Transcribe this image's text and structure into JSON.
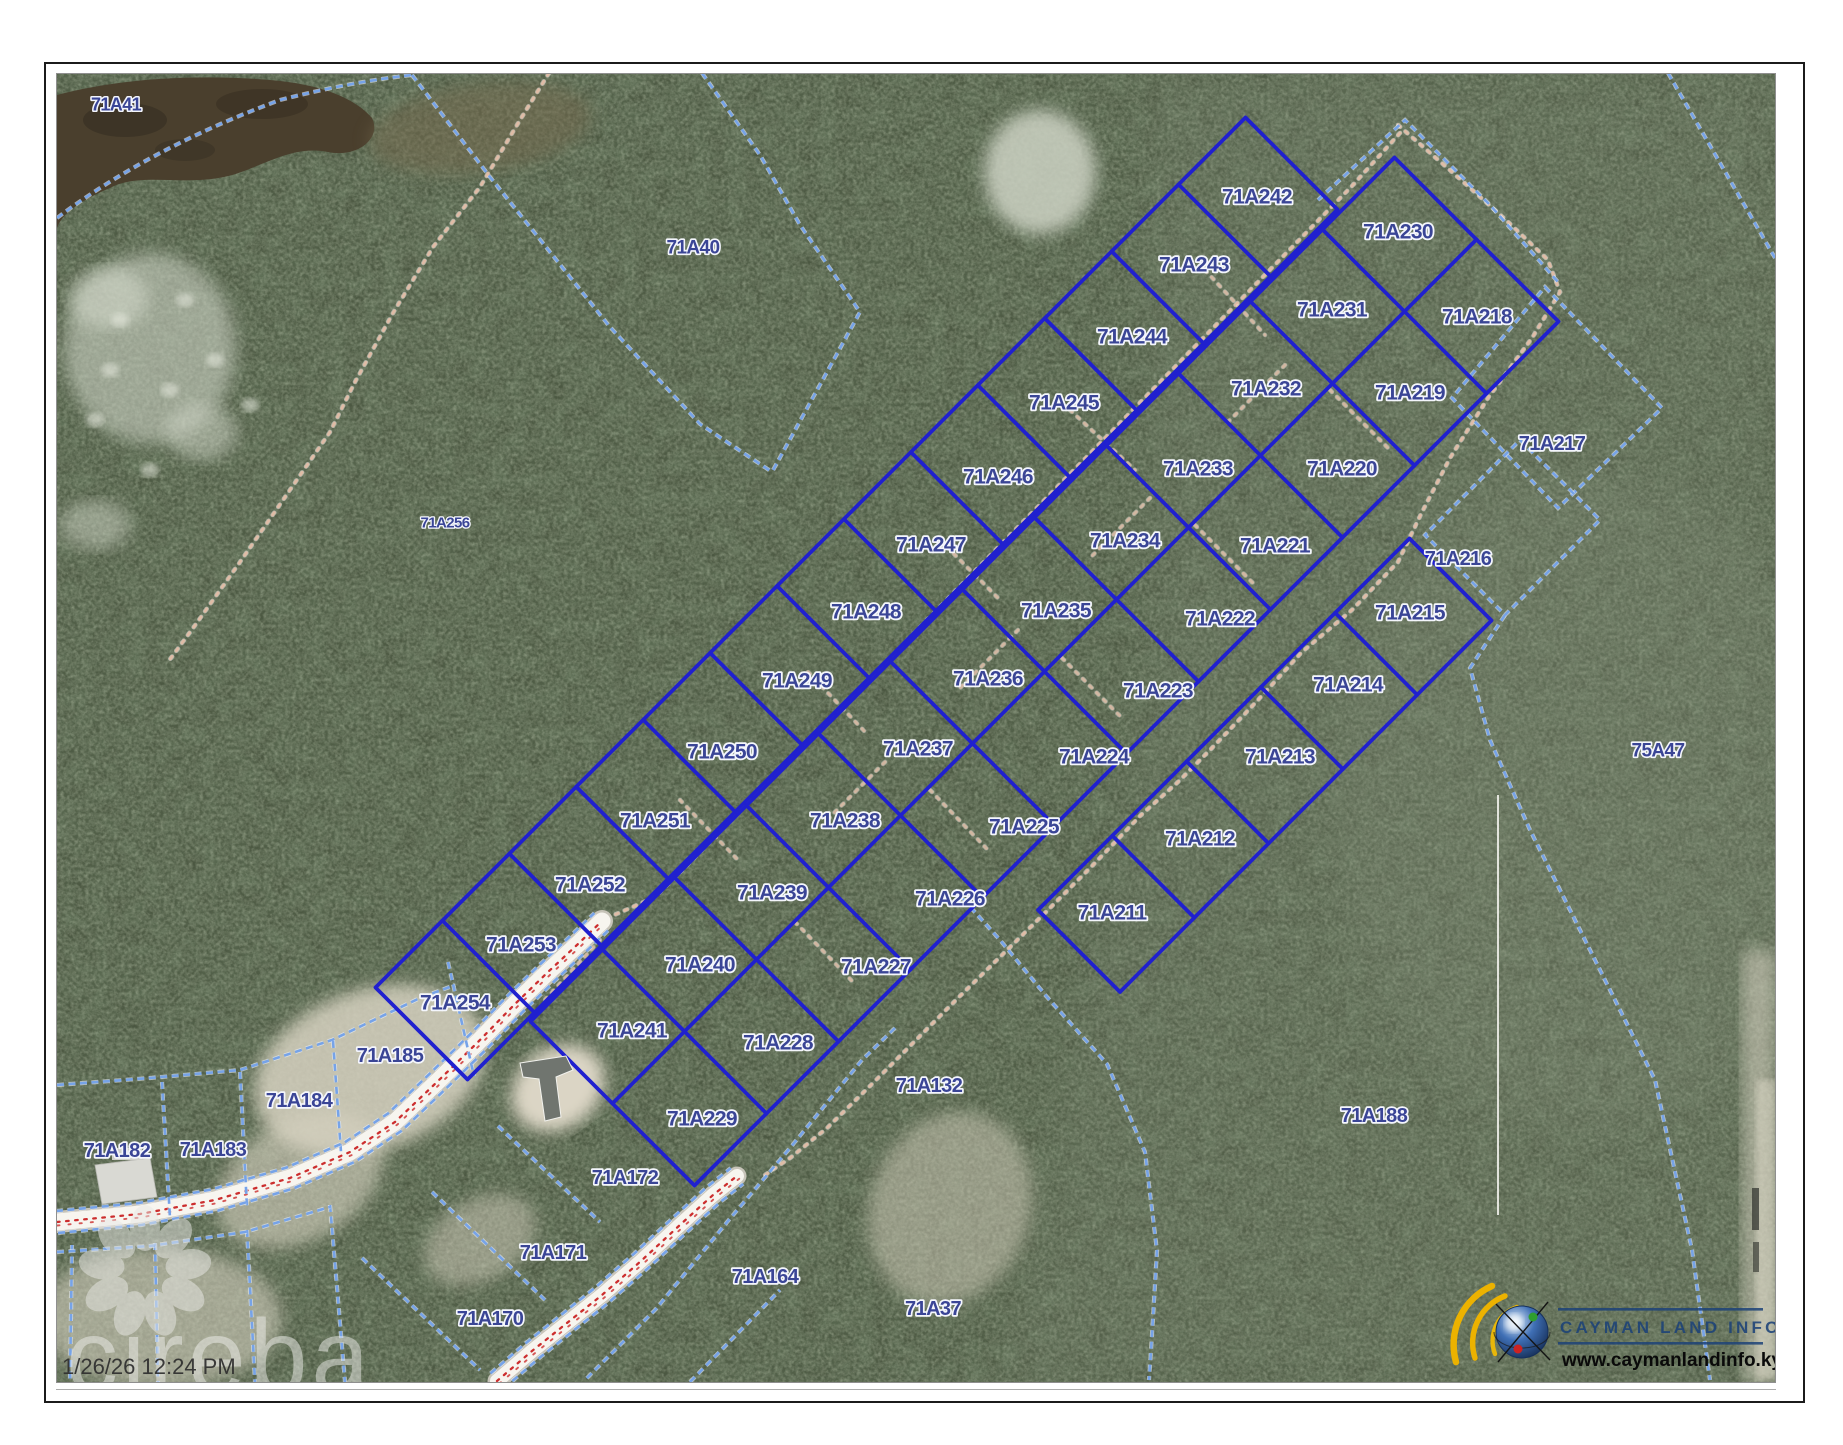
{
  "page": {
    "type": "cadastral-map-export",
    "timestamp": "1/26/26 12:24 PM",
    "watermark": "cireba"
  },
  "logo": {
    "name": "Cayman Land Info",
    "line1": "CAYMAN LAND INFO",
    "line2": "www.caymanlandinfo.ky"
  },
  "colors": {
    "parcel_line_solid": "#2020cf",
    "parcel_line_dashed": "#76a3e8",
    "dashed_casing": "#eef3fb",
    "road_fill": "#f7f5ef",
    "road_casing": "#c7c4b9",
    "road_centerline": "#cc2e2e",
    "trail_dot": "#e2bda6",
    "label_fill": "#3a4596",
    "label_halo": "#f4f6fc",
    "water": "#4a3f2d",
    "sand": "#d9d4c3",
    "logo_navy": "#1c4278",
    "logo_yellow": "#ecb200"
  },
  "map": {
    "parcels": [
      [
        "71A41",
        116,
        104,
        18
      ],
      [
        "71A40",
        693,
        247,
        19
      ],
      [
        "71A256",
        445,
        522,
        15
      ],
      [
        "75A47",
        1658,
        750,
        19
      ],
      [
        "71A242",
        1257,
        196
      ],
      [
        "71A243",
        1194,
        264
      ],
      [
        "71A244",
        1132,
        336
      ],
      [
        "71A245",
        1064,
        402
      ],
      [
        "71A246",
        998,
        476
      ],
      [
        "71A247",
        931,
        544
      ],
      [
        "71A248",
        866,
        611
      ],
      [
        "71A249",
        797,
        680
      ],
      [
        "71A250",
        722,
        751
      ],
      [
        "71A251",
        655,
        820
      ],
      [
        "71A252",
        590,
        884
      ],
      [
        "71A253",
        521,
        944
      ],
      [
        "71A254",
        455,
        1002
      ],
      [
        "71A230",
        1398,
        231
      ],
      [
        "71A231",
        1332,
        309
      ],
      [
        "71A232",
        1266,
        388
      ],
      [
        "71A233",
        1198,
        468
      ],
      [
        "71A234",
        1125,
        540
      ],
      [
        "71A235",
        1056,
        610
      ],
      [
        "71A236",
        988,
        678
      ],
      [
        "71A237",
        918,
        748
      ],
      [
        "71A238",
        845,
        820
      ],
      [
        "71A239",
        772,
        892
      ],
      [
        "71A240",
        700,
        964
      ],
      [
        "71A241",
        632,
        1030
      ],
      [
        "71A218",
        1477,
        316
      ],
      [
        "71A219",
        1410,
        392
      ],
      [
        "71A220",
        1342,
        468
      ],
      [
        "71A221",
        1275,
        545
      ],
      [
        "71A222",
        1220,
        618
      ],
      [
        "71A223",
        1158,
        690
      ],
      [
        "71A224",
        1094,
        756
      ],
      [
        "71A225",
        1024,
        826
      ],
      [
        "71A226",
        950,
        898
      ],
      [
        "71A227",
        876,
        966
      ],
      [
        "71A228",
        778,
        1042
      ],
      [
        "71A229",
        702,
        1118
      ],
      [
        "71A217",
        1552,
        443,
        20
      ],
      [
        "71A216",
        1458,
        558,
        20
      ],
      [
        "71A215",
        1410,
        612
      ],
      [
        "71A214",
        1348,
        684
      ],
      [
        "71A213",
        1280,
        756
      ],
      [
        "71A212",
        1200,
        838
      ],
      [
        "71A211",
        1112,
        912
      ],
      [
        "71A188",
        1374,
        1115,
        20
      ],
      [
        "71A132",
        929,
        1085,
        20
      ],
      [
        "71A37",
        933,
        1308,
        20
      ],
      [
        "71A185",
        390,
        1055,
        20
      ],
      [
        "71A184",
        299,
        1100,
        20
      ],
      [
        "71A183",
        213,
        1149,
        20
      ],
      [
        "71A182",
        117,
        1150,
        20
      ],
      [
        "71A172",
        625,
        1177,
        20
      ],
      [
        "71A171",
        553,
        1252,
        20
      ],
      [
        "71A164",
        765,
        1276,
        20
      ],
      [
        "71A170",
        490,
        1318,
        20
      ]
    ]
  }
}
